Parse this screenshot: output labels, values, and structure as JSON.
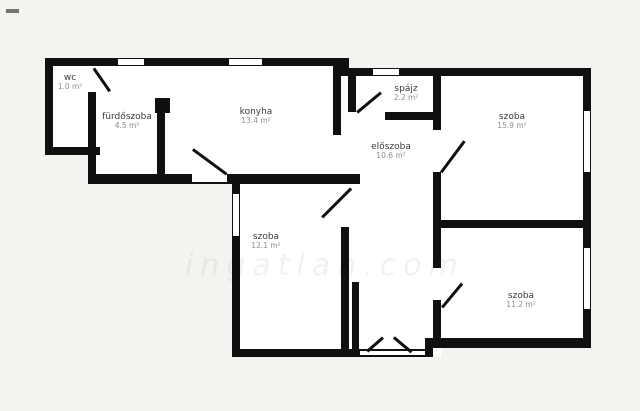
{
  "title": "apartment floor plan",
  "colors": {
    "page_background": "#f4f3f0",
    "room_fill": "#ffffff",
    "wall": "#101010",
    "label_text": "#3a3a3a",
    "area_text": "#8d8d8d"
  },
  "watermark": {
    "text": "ingatlan.com"
  },
  "rooms": [
    {
      "id": "wc",
      "name": "wc",
      "area": "1.0 m²"
    },
    {
      "id": "furdoszoba",
      "name": "fürdőszoba",
      "area": "4.5 m²"
    },
    {
      "id": "konyha",
      "name": "konyha",
      "area": "13.4 m²"
    },
    {
      "id": "spajz",
      "name": "spájz",
      "area": "2.2 m²"
    },
    {
      "id": "eloszoba",
      "name": "előszoba",
      "area": "10.6 m²"
    },
    {
      "id": "szoba-top-right",
      "name": "szoba",
      "area": "15.9 m²"
    },
    {
      "id": "szoba-middle-left",
      "name": "szoba",
      "area": "12.1 m²"
    },
    {
      "id": "szoba-bottom-right",
      "name": "szoba",
      "area": "11.2 m²"
    }
  ]
}
